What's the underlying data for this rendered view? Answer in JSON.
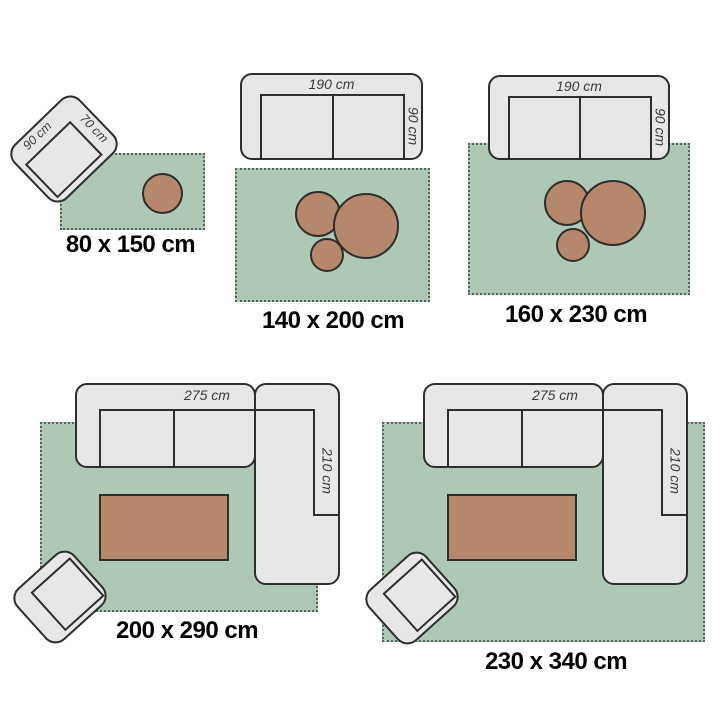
{
  "colors": {
    "background": "#ffffff",
    "rug_green": "#afc8b5",
    "rug_edge_dots": "#55655a",
    "furniture_fill": "#e7e7e7",
    "outline": "#2e2e2e",
    "wood_brown": "#b5886b",
    "label_text": "#000000",
    "dimension_text": "#3a3a3a"
  },
  "scenes": [
    {
      "size_label": "80 x 150 cm",
      "chair": {
        "width_label": "90 cm",
        "depth_label": "70 cm"
      }
    },
    {
      "size_label": "140 x 200 cm",
      "sofa": {
        "width_label": "190 cm",
        "depth_label": "90 cm"
      }
    },
    {
      "size_label": "160 x 230 cm",
      "sofa": {
        "width_label": "190 cm",
        "depth_label": "90 cm"
      }
    },
    {
      "size_label": "200 x 290 cm",
      "sofa": {
        "width_label": "275 cm",
        "depth_label": "210 cm"
      }
    },
    {
      "size_label": "230 x 340 cm",
      "sofa": {
        "width_label": "275 cm",
        "depth_label": "210 cm"
      }
    }
  ]
}
